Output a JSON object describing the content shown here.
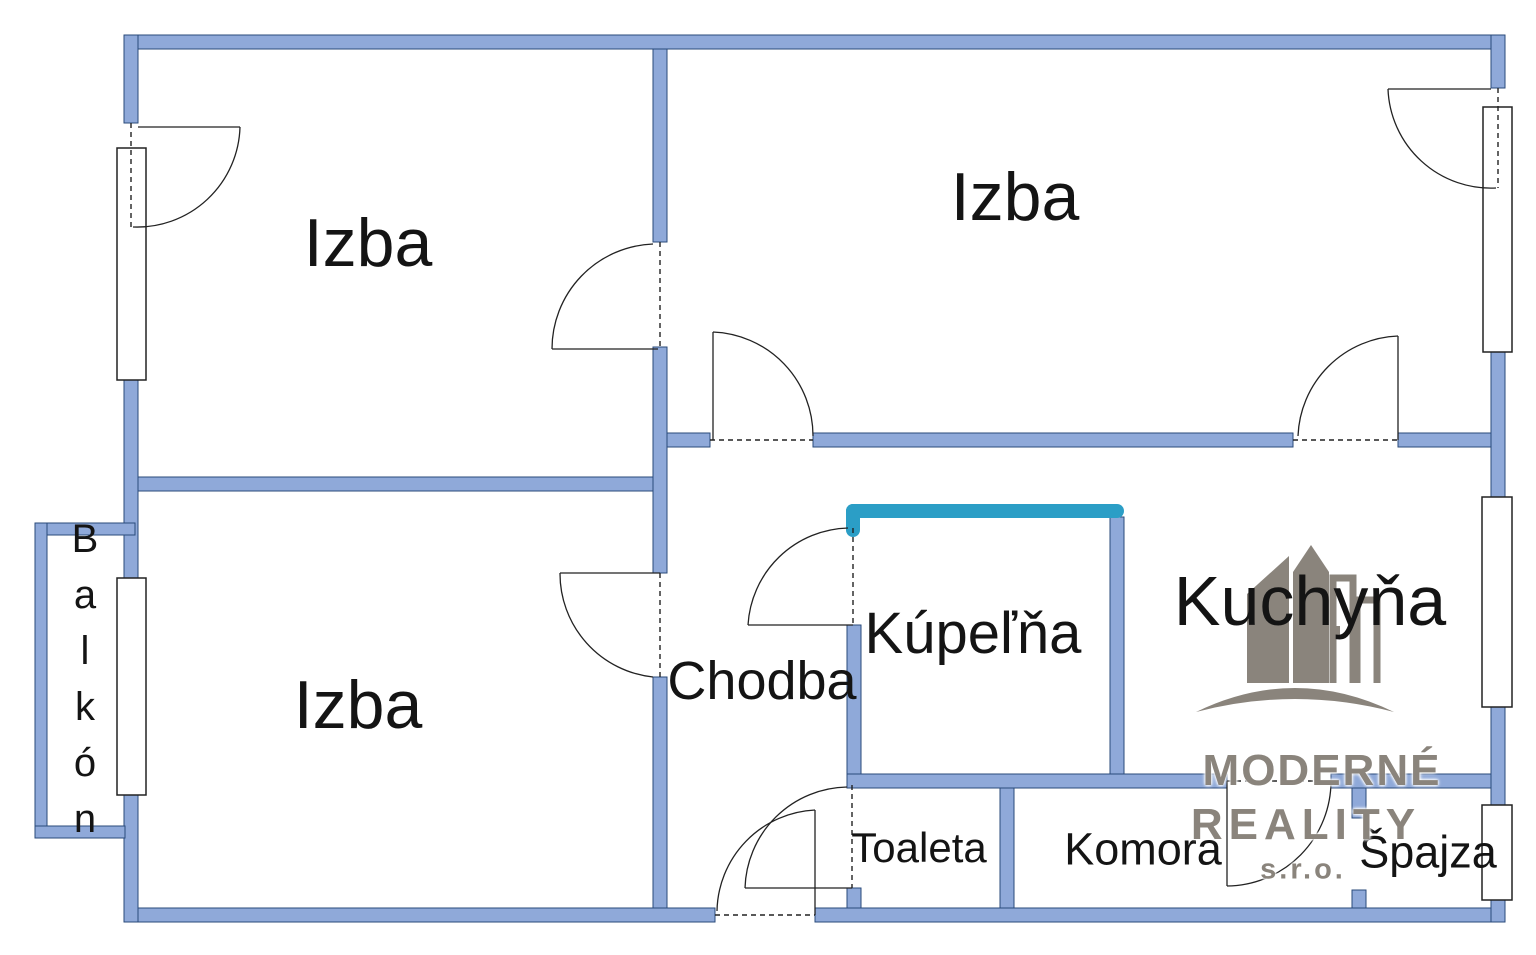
{
  "rooms": {
    "izba_top_left": {
      "label": "Izba"
    },
    "izba_top_right": {
      "label": "Izba"
    },
    "izba_bottom_left": {
      "label": "Izba"
    },
    "balkon": {
      "label": "Balkón"
    },
    "chodba": {
      "label": "Chodba"
    },
    "kupelna": {
      "label": "Kúpeľňa"
    },
    "kuchyna": {
      "label": "Kuchyňa"
    },
    "toaleta": {
      "label": "Toaleta"
    },
    "komora": {
      "label": "Komora"
    },
    "spajza": {
      "label": "Špajza"
    }
  },
  "watermark": {
    "brand_line1": "MODERNÉ",
    "brand_line2": "REALITY",
    "brand_line3": "s.r.o."
  },
  "colors": {
    "wall_fill": "#8fa9d9",
    "wall_outline": "#2a4a7a",
    "highlight_teal": "#2b9ec6",
    "logo_gray": "#8a847c",
    "label_text": "#141414",
    "door_line": "#222222",
    "background": "#ffffff"
  }
}
